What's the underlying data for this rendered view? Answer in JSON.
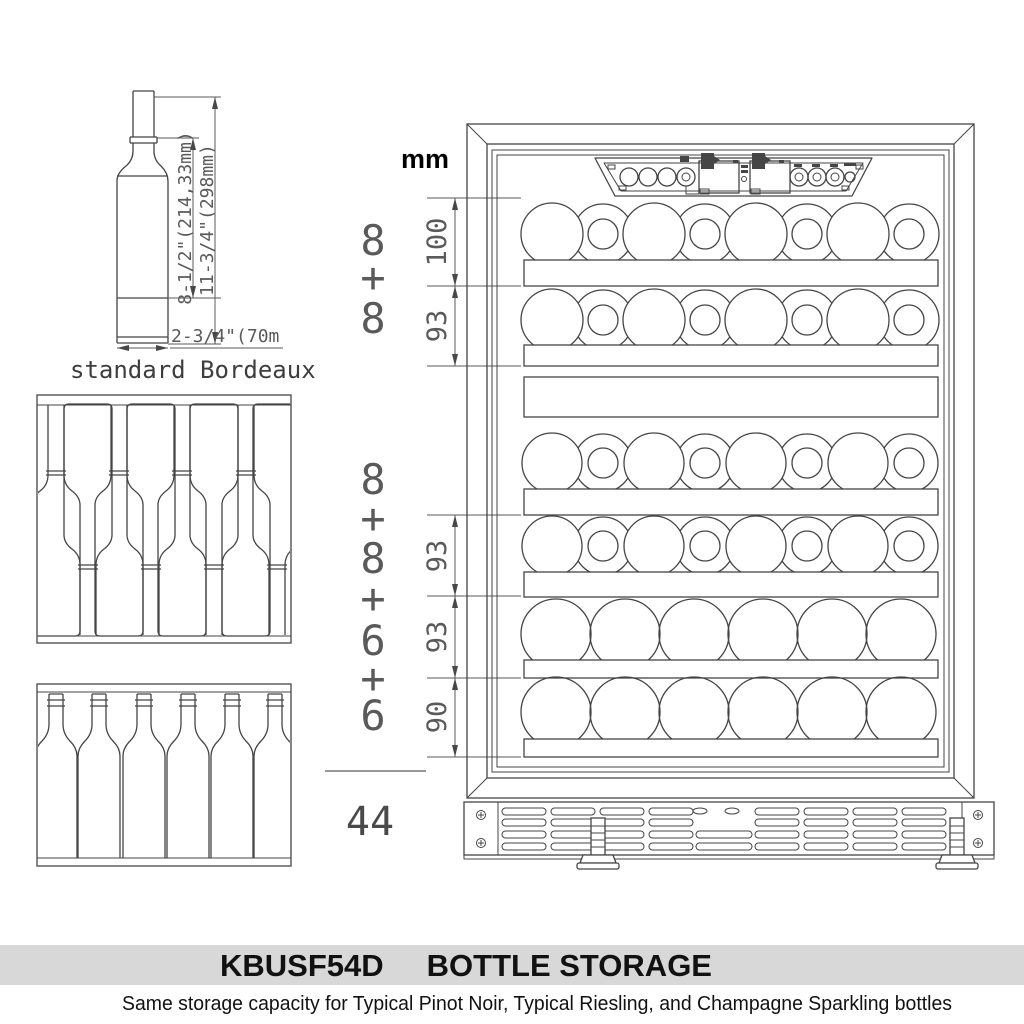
{
  "labels": {
    "unit": "mm",
    "total": "44",
    "standard_bottle": "standard Bordeaux"
  },
  "bottle_dims": {
    "body_height": "8-1/2\"(214,33mm)",
    "overall_height": "11-3/4\"(298mm)",
    "base_width": "2-3/4\"(70m"
  },
  "upper_section": {
    "counts": [
      "8",
      "+",
      "8"
    ],
    "dims": [
      "100",
      "93"
    ]
  },
  "lower_section": {
    "counts": [
      "8",
      "+",
      "8",
      "+",
      "6",
      "+",
      "6"
    ],
    "dims": [
      "93",
      "93",
      "90"
    ]
  },
  "cooler": {
    "rows": [
      {
        "bottles": 8
      },
      {
        "bottles": 8
      },
      {
        "bottles": 8
      },
      {
        "bottles": 8
      },
      {
        "bottles": 6
      },
      {
        "bottles": 6
      }
    ],
    "total_bottles": 44
  },
  "footer": {
    "model": "KBUSF54D",
    "title": "BOTTLE STORAGE",
    "subtitle": "Same storage capacity for Typical Pinot Noir, Typical Riesling, and Champagne Sparkling bottles"
  },
  "colors": {
    "line": "#454545",
    "dim_text": "#5a5a5a",
    "band": "#d8d8d8",
    "text": "#111111"
  }
}
